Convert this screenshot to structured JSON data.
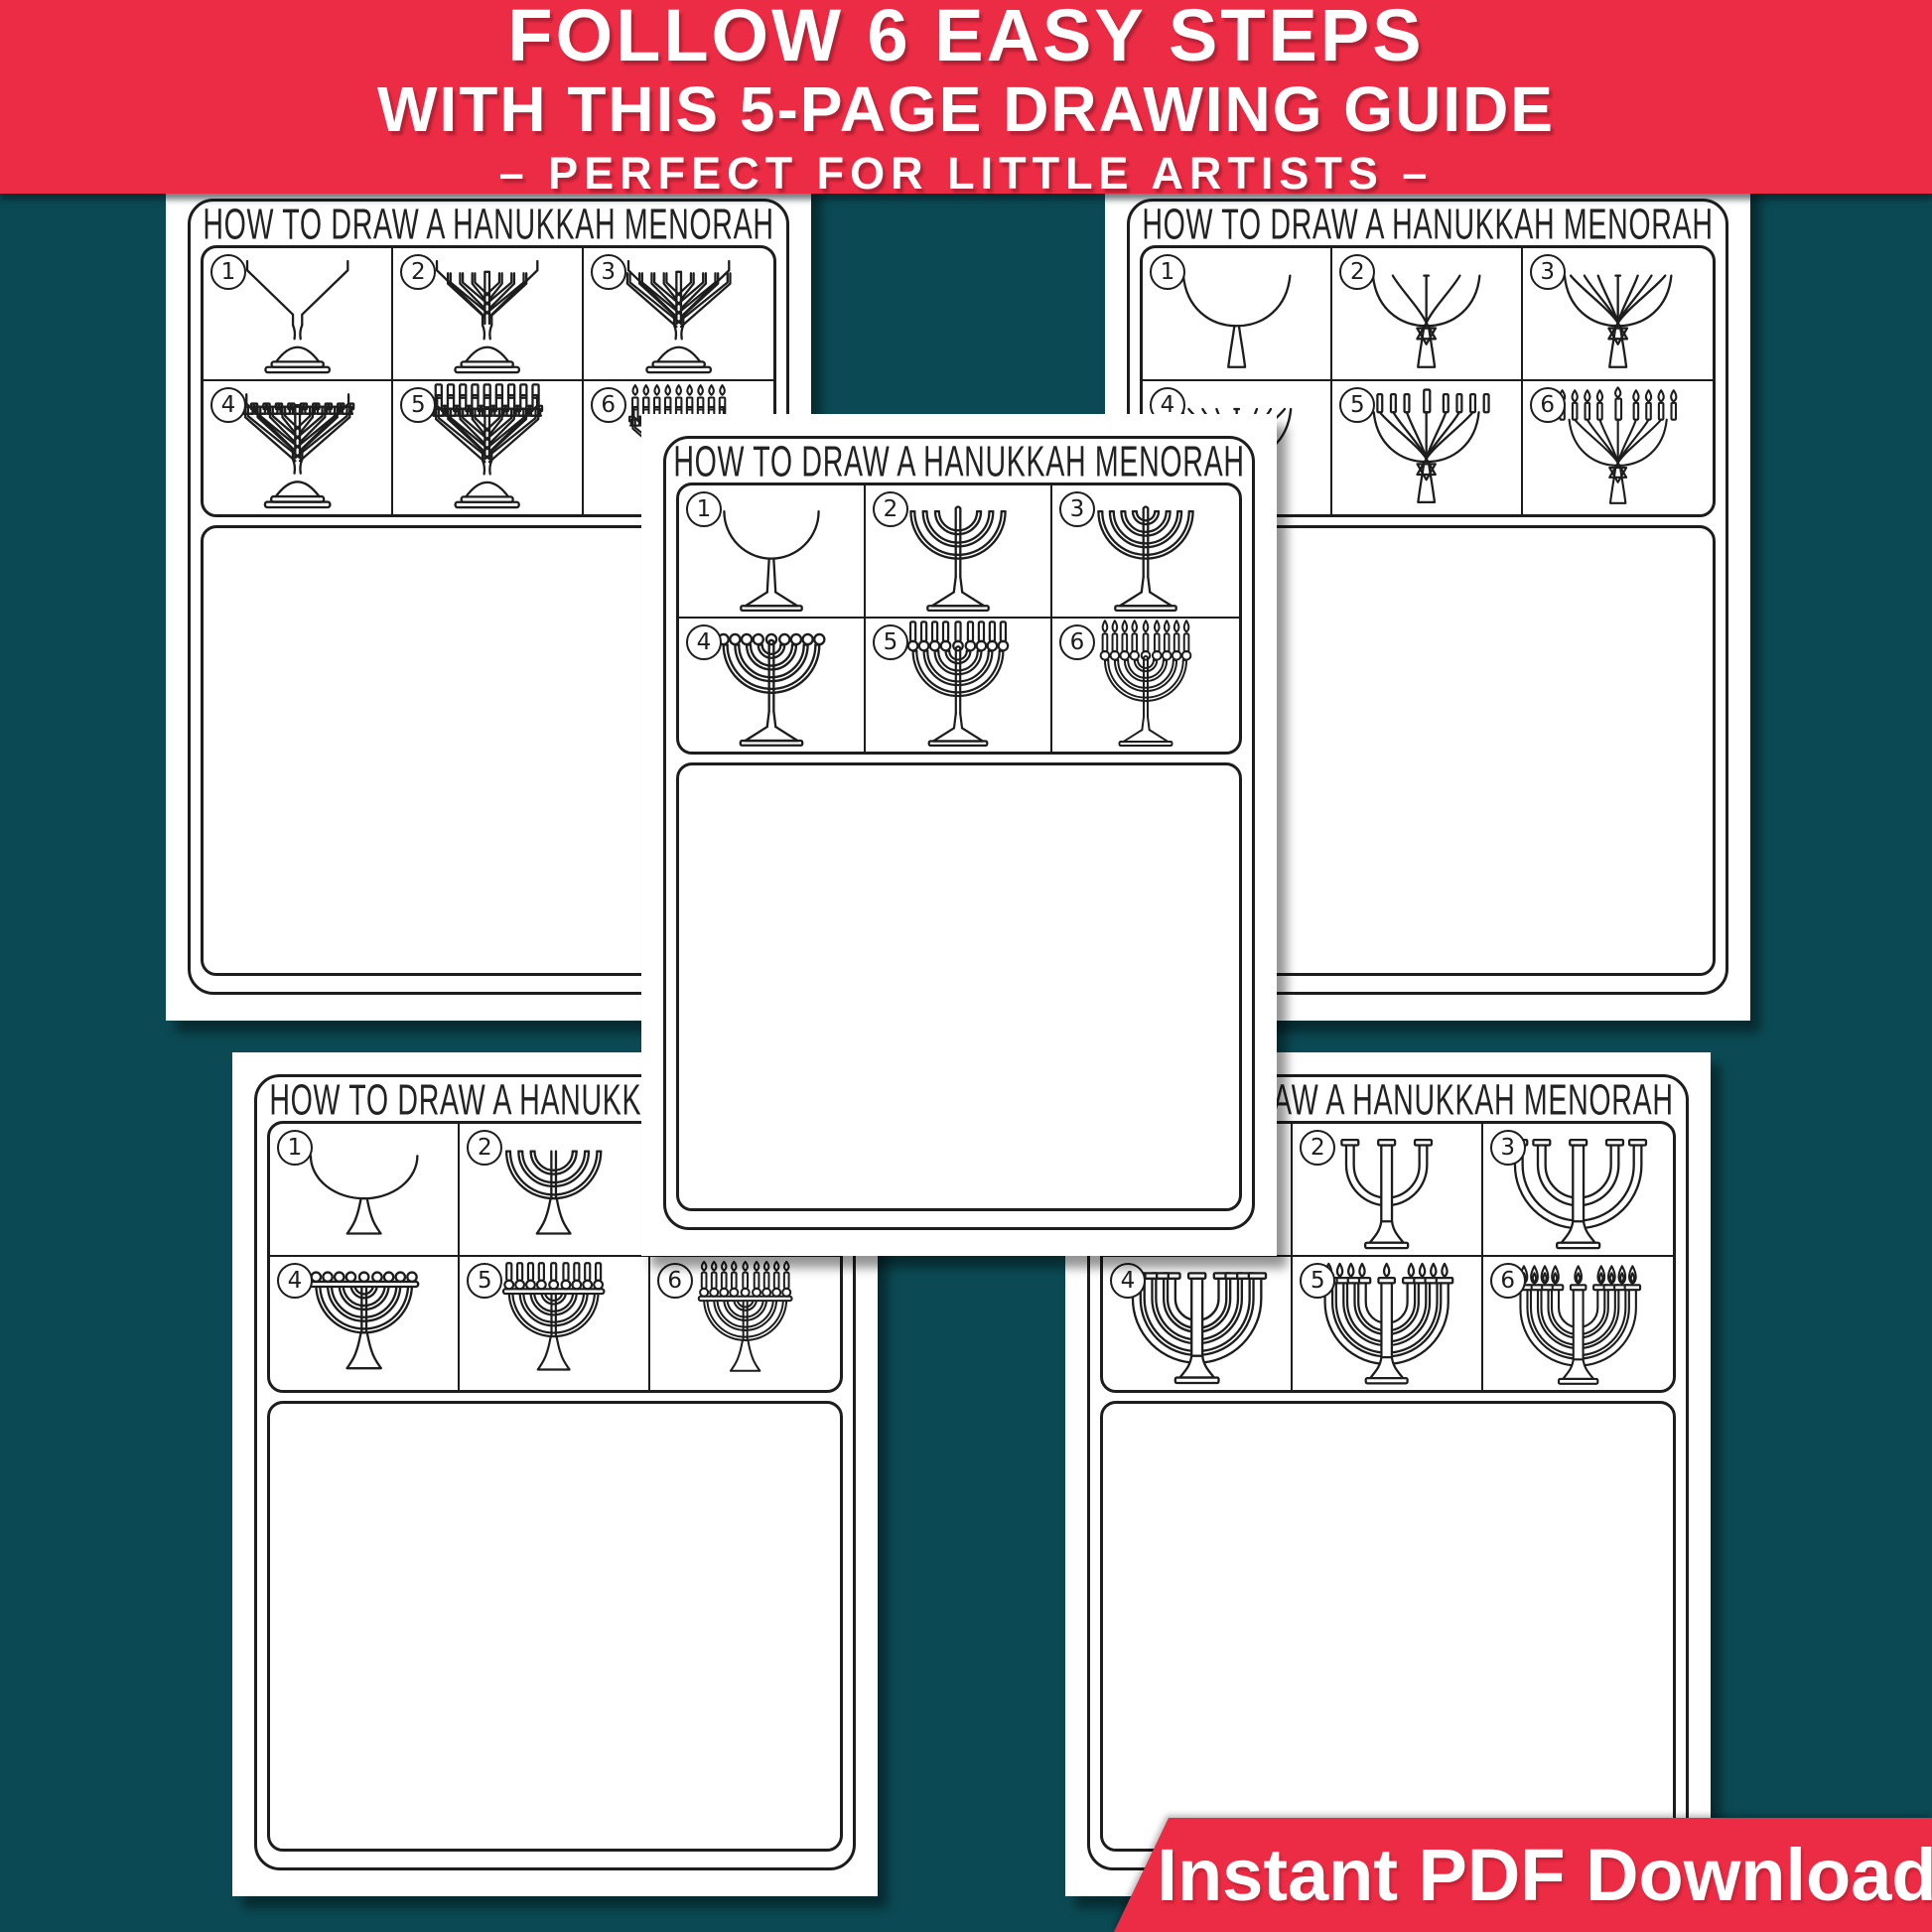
{
  "banner": {
    "line1": "FOLLOW 6 EASY STEPS",
    "line2": "WITH THIS 5-PAGE DRAWING GUIDE",
    "line3": "– PERFECT FOR LITTLE ARTISTS –"
  },
  "worksheet_title": "HOW TO DRAW A HANUKKAH MENORAH",
  "ribbon": {
    "label": "Instant PDF Download"
  },
  "colors": {
    "red": "#ec2b44",
    "teal": "#0b4a54",
    "ink": "#1d1d1d",
    "paper": "#ffffff"
  },
  "step_numbers": [
    "1",
    "2",
    "3",
    "4",
    "5",
    "6"
  ],
  "pages": [
    {
      "id": "top-left",
      "style": "angular",
      "menorah": "angular-branch menorah with ornate candle holders"
    },
    {
      "id": "top-right",
      "style": "fan",
      "menorah": "fanned-arm menorah with Star of David stem"
    },
    {
      "id": "center",
      "style": "goblet",
      "menorah": "classic round-arm menorah with ball cups"
    },
    {
      "id": "bottom-left",
      "style": "bar",
      "menorah": "round-arm menorah with top bar and cups"
    },
    {
      "id": "bottom-right",
      "style": "tube",
      "menorah": "wide tubular-arm menorah with flat cups"
    }
  ]
}
